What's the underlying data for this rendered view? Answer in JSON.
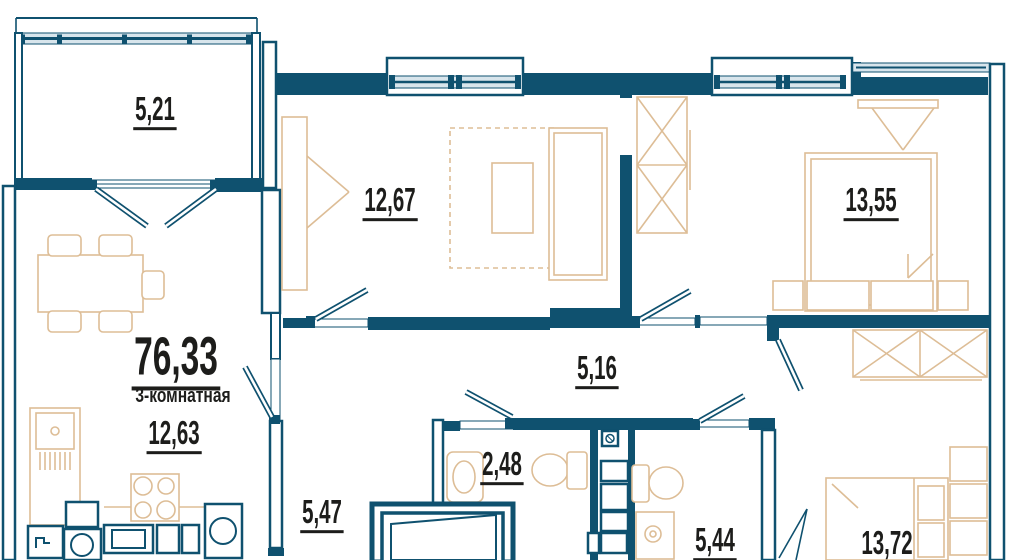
{
  "plan": {
    "total_area": "76,33",
    "apartment_type": "3-комнатная",
    "rooms": {
      "balcony": "5,21",
      "bedroom_top_left": "12,67",
      "bedroom_top_right": "13,55",
      "kitchen_living": "12,63",
      "hallway": "5,16",
      "bathroom": "2,48",
      "entry_corridor": "5,47",
      "wc": "5,44",
      "bedroom_bottom_right": "13,72"
    },
    "colors": {
      "wall": "#0f516f",
      "furniture_outline": "#ddbd96",
      "glazing": "#d8e5ec",
      "label": "#1d1d1b",
      "background": "#ffffff"
    }
  }
}
